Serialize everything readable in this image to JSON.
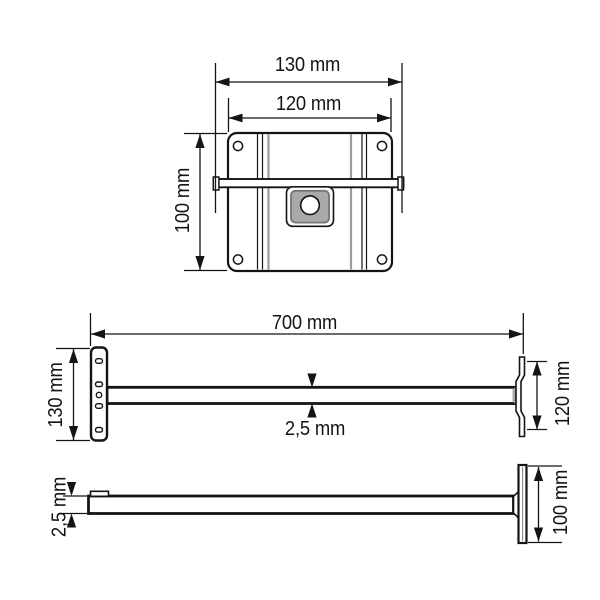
{
  "drawing": {
    "kind": "technical-dimension-drawing",
    "views": {
      "top": {
        "dim_width_outer": "130 mm",
        "dim_width_inner": "120 mm",
        "dim_height": "100 mm"
      },
      "side": {
        "dim_length": "700 mm",
        "dim_left_plate_height": "130 mm",
        "dim_right_plate_height": "120 mm",
        "dim_thickness": "2,5 mm"
      },
      "profile": {
        "dim_thickness": "2,5 mm",
        "dim_plate_height": "100 mm"
      }
    },
    "colors": {
      "line": "#141414",
      "gray_bend_line": "#9c9c9c",
      "hub_fill": "#a9a9a9",
      "hub_border": "#757575",
      "background": "#ffffff"
    }
  }
}
